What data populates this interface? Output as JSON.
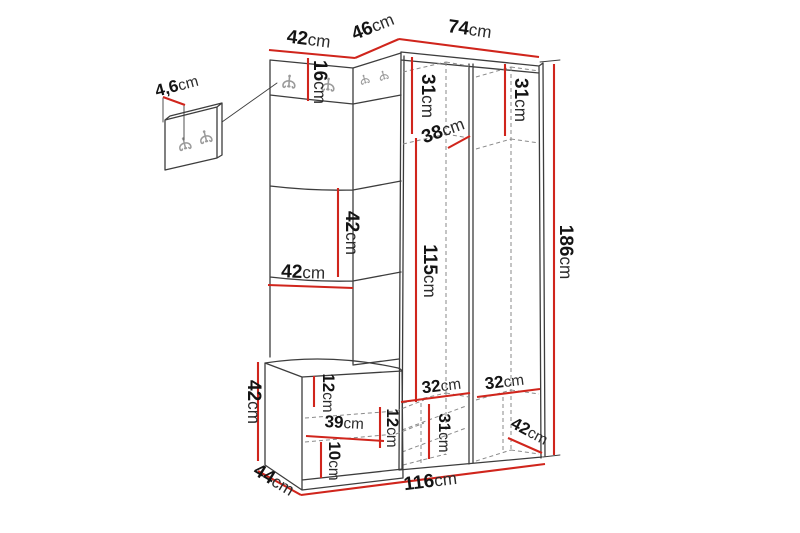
{
  "diagram": {
    "type": "furniture-dimension-drawing",
    "subject": "hallway-set-with-hook-panel-bench-and-corner-wardrobe",
    "unit": "cm",
    "colors": {
      "dimension_line": "#d0251c",
      "outline": "#3d3d3d",
      "hidden_line": "#8a8a8a",
      "hook": "#9b9b9b",
      "text": "#141414",
      "background": "#ffffff"
    },
    "labels": {
      "top_width_left": {
        "value": "42",
        "unit": "cm"
      },
      "top_width_corner": {
        "value": "46",
        "unit": "cm"
      },
      "top_width_right": {
        "value": "74",
        "unit": "cm"
      },
      "wall_panel_thickness": {
        "value": "4,6",
        "unit": "cm"
      },
      "hook_strip_height": {
        "value": "16",
        "unit": "cm"
      },
      "left_top_compartment_height": {
        "value": "31",
        "unit": "cm"
      },
      "right_top_compartment_height": {
        "value": "31",
        "unit": "cm"
      },
      "top_compartment_depth": {
        "value": "38",
        "unit": "cm"
      },
      "total_height": {
        "value": "186",
        "unit": "cm"
      },
      "panel_segment_height": {
        "value": "42",
        "unit": "cm"
      },
      "panel_width": {
        "value": "42",
        "unit": "cm"
      },
      "hanging_space_height": {
        "value": "115",
        "unit": "cm"
      },
      "bench_height": {
        "value": "42",
        "unit": "cm"
      },
      "bench_top_height": {
        "value": "12",
        "unit": "cm"
      },
      "bench_inner_width": {
        "value": "39",
        "unit": "cm"
      },
      "bench_inner_height": {
        "value": "12",
        "unit": "cm"
      },
      "bench_base_height": {
        "value": "10",
        "unit": "cm"
      },
      "bench_depth": {
        "value": "44",
        "unit": "cm"
      },
      "left_compartment_width": {
        "value": "32",
        "unit": "cm"
      },
      "right_compartment_width": {
        "value": "32",
        "unit": "cm"
      },
      "bottom_compartment_height": {
        "value": "31",
        "unit": "cm"
      },
      "bottom_compartment_depth": {
        "value": "42",
        "unit": "cm"
      },
      "total_width": {
        "value": "116",
        "unit": "cm"
      }
    }
  }
}
